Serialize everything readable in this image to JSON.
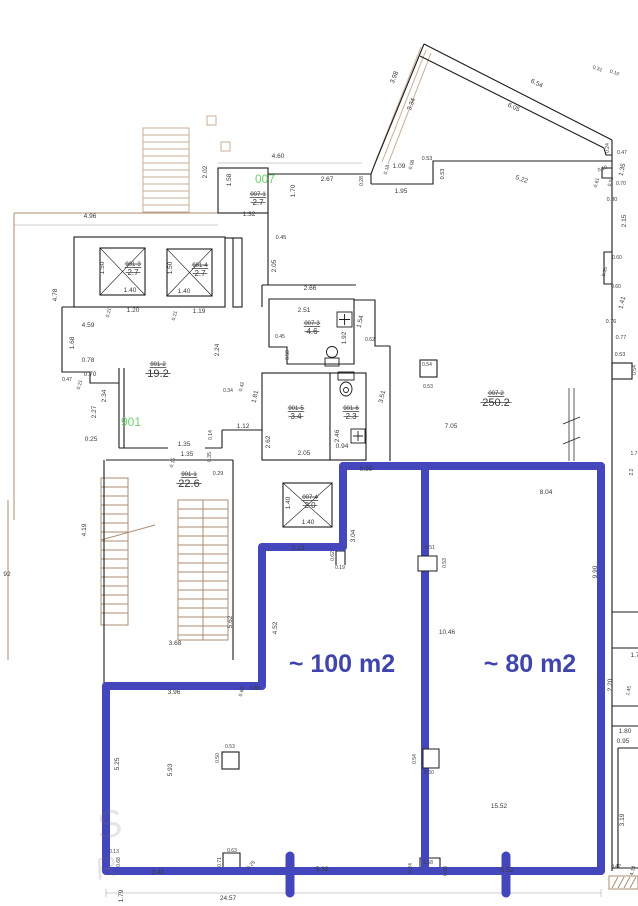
{
  "title": "floor-plan",
  "colors": {
    "wall_blue": "#4347bb",
    "label_blue": "#3f45ad",
    "green": "#6fd06f",
    "brown": "#ab8d73",
    "brown_light": "#c7ae97",
    "dim_text": "#3a3a3a",
    "wall_black": "#1c1c1c"
  },
  "area_labels": [
    {
      "t": "~ 100 m2",
      "x": 342,
      "y": 672
    },
    {
      "t": "~ 80 m2",
      "x": 530,
      "y": 672
    }
  ],
  "green_labels": [
    {
      "t": "007",
      "x": 265,
      "y": 183
    },
    {
      "t": "901",
      "x": 131,
      "y": 426
    }
  ],
  "room_labels": [
    {
      "code": "007-1",
      "value": "2.7",
      "x": 258,
      "y": 196,
      "big": false
    },
    {
      "code": "901-3",
      "value": "2.7",
      "x": 133,
      "y": 266,
      "big": false
    },
    {
      "code": "901-4",
      "value": "2.7",
      "x": 200,
      "y": 267,
      "big": false
    },
    {
      "code": "007-3",
      "value": "4.6",
      "x": 312,
      "y": 325,
      "big": false
    },
    {
      "code": "901-2",
      "value": "19.2",
      "x": 158,
      "y": 366,
      "big": true
    },
    {
      "code": "901-5",
      "value": "3.4",
      "x": 296,
      "y": 410,
      "big": false
    },
    {
      "code": "901-6",
      "value": "2.3",
      "x": 351,
      "y": 410,
      "big": false
    },
    {
      "code": "007-2",
      "value": "250.2",
      "x": 496,
      "y": 395,
      "big": true
    },
    {
      "code": "901-1",
      "value": "22.6",
      "x": 189,
      "y": 476,
      "big": true
    },
    {
      "code": "007-4",
      "value": "2.0",
      "x": 310,
      "y": 499,
      "big": false
    }
  ],
  "dims": [
    {
      "t": "4.96",
      "x": 90,
      "y": 218
    },
    {
      "t": "4.60",
      "x": 278,
      "y": 158
    },
    {
      "t": "2.02",
      "x": 207,
      "y": 172,
      "r": -90
    },
    {
      "t": "1.58",
      "x": 231,
      "y": 180,
      "r": -90
    },
    {
      "t": "2.67",
      "x": 327,
      "y": 181
    },
    {
      "t": "0.28",
      "x": 363,
      "y": 181,
      "r": -90,
      "s": 5
    },
    {
      "t": "1.09",
      "x": 399,
      "y": 168
    },
    {
      "t": "0.18",
      "x": 388,
      "y": 170,
      "r": -75,
      "s": 5
    },
    {
      "t": "0.08",
      "x": 413,
      "y": 165,
      "r": -75,
      "s": 5
    },
    {
      "t": "0.53",
      "x": 427,
      "y": 160,
      "s": 5.5
    },
    {
      "t": "1.95",
      "x": 401,
      "y": 193
    },
    {
      "t": "0.53",
      "x": 444,
      "y": 174,
      "r": -90,
      "s": 5.5
    },
    {
      "t": "1.70",
      "x": 295,
      "y": 191,
      "r": -90
    },
    {
      "t": "1.32",
      "x": 249,
      "y": 216
    },
    {
      "t": "0.45",
      "x": 281,
      "y": 239,
      "s": 5.5
    },
    {
      "t": "2.05",
      "x": 276,
      "y": 266,
      "r": -90
    },
    {
      "t": "3.98",
      "x": 396,
      "y": 78,
      "r": -68
    },
    {
      "t": "3.34",
      "x": 413,
      "y": 105,
      "r": -68
    },
    {
      "t": "6.54",
      "x": 536,
      "y": 85,
      "r": 26
    },
    {
      "t": "6.05",
      "x": 513,
      "y": 109,
      "r": 26
    },
    {
      "t": "5.22",
      "x": 521,
      "y": 181,
      "r": 20
    },
    {
      "t": "0.31",
      "x": 597,
      "y": 70,
      "r": 20,
      "s": 5
    },
    {
      "t": "0.10",
      "x": 614,
      "y": 74,
      "r": 20,
      "s": 5
    },
    {
      "t": "0.24",
      "x": 609,
      "y": 148,
      "r": -90,
      "s": 5
    },
    {
      "t": "0.47",
      "x": 622,
      "y": 154,
      "s": 5
    },
    {
      "t": "1.35",
      "x": 624,
      "y": 170,
      "r": -78
    },
    {
      "t": "0.10",
      "x": 603,
      "y": 170,
      "r": -20,
      "s": 5
    },
    {
      "t": "0.61",
      "x": 598,
      "y": 183,
      "r": -75,
      "s": 5
    },
    {
      "t": "0.51",
      "x": 612,
      "y": 182,
      "r": -75,
      "s": 5
    },
    {
      "t": "0.70",
      "x": 621,
      "y": 185,
      "s": 5
    },
    {
      "t": "0.80",
      "x": 612,
      "y": 201,
      "s": 5.5
    },
    {
      "t": "2.15",
      "x": 626,
      "y": 221,
      "r": -90
    },
    {
      "t": "0.60",
      "x": 617,
      "y": 259,
      "s": 5
    },
    {
      "t": "0.55",
      "x": 606,
      "y": 272,
      "r": -75,
      "s": 5
    },
    {
      "t": "0.60",
      "x": 616,
      "y": 288,
      "s": 5
    },
    {
      "t": "1.41",
      "x": 624,
      "y": 303,
      "r": -78
    },
    {
      "t": "0.76",
      "x": 611,
      "y": 323,
      "s": 5.5
    },
    {
      "t": "0.77",
      "x": 621,
      "y": 339,
      "s": 5.5
    },
    {
      "t": "0.53",
      "x": 620,
      "y": 356,
      "s": 5.5
    },
    {
      "t": "0.54",
      "x": 636,
      "y": 370,
      "r": -90,
      "s": 5
    },
    {
      "t": "1.50",
      "x": 104,
      "y": 268,
      "r": -90
    },
    {
      "t": "1.40",
      "x": 130,
      "y": 292
    },
    {
      "t": "1.50",
      "x": 172,
      "y": 268,
      "r": -90
    },
    {
      "t": "1.40",
      "x": 184,
      "y": 293
    },
    {
      "t": "0.21",
      "x": 110,
      "y": 313,
      "r": -75,
      "s": 5
    },
    {
      "t": "1.20",
      "x": 133,
      "y": 312
    },
    {
      "t": "0.21",
      "x": 176,
      "y": 316,
      "r": -75,
      "s": 5
    },
    {
      "t": "1.19",
      "x": 199,
      "y": 313
    },
    {
      "t": "4.59",
      "x": 88,
      "y": 327
    },
    {
      "t": "4.78",
      "x": 57,
      "y": 295,
      "r": -90
    },
    {
      "t": "1.68",
      "x": 74,
      "y": 343,
      "r": -90
    },
    {
      "t": "2.24",
      "x": 219,
      "y": 350,
      "r": -90
    },
    {
      "t": "2.66",
      "x": 310,
      "y": 290
    },
    {
      "t": "2.51",
      "x": 304,
      "y": 312
    },
    {
      "t": "0.45",
      "x": 280,
      "y": 338,
      "s": 5
    },
    {
      "t": "1.54",
      "x": 362,
      "y": 322,
      "r": -78
    },
    {
      "t": "1.92",
      "x": 346,
      "y": 338,
      "r": -90
    },
    {
      "t": "0.62",
      "x": 370,
      "y": 341,
      "s": 5
    },
    {
      "t": "0.58",
      "x": 289,
      "y": 355,
      "r": -90,
      "s": 5
    },
    {
      "t": "0.78",
      "x": 88,
      "y": 362
    },
    {
      "t": "0.70",
      "x": 90,
      "y": 376
    },
    {
      "t": "0.47",
      "x": 67,
      "y": 381,
      "s": 5
    },
    {
      "t": "0.21",
      "x": 81,
      "y": 385,
      "r": -75,
      "s": 5
    },
    {
      "t": "2.34",
      "x": 106,
      "y": 396,
      "r": -90
    },
    {
      "t": "2.27",
      "x": 96,
      "y": 412,
      "r": -90
    },
    {
      "t": "0.25",
      "x": 91,
      "y": 441
    },
    {
      "t": "0.34",
      "x": 228,
      "y": 392,
      "s": 5
    },
    {
      "t": "0.42",
      "x": 243,
      "y": 387,
      "r": -75,
      "s": 5
    },
    {
      "t": "1.81",
      "x": 257,
      "y": 397,
      "r": -78
    },
    {
      "t": "1.12",
      "x": 243,
      "y": 428
    },
    {
      "t": "0.14",
      "x": 212,
      "y": 435,
      "r": -90,
      "s": 5
    },
    {
      "t": "1.35",
      "x": 184,
      "y": 446
    },
    {
      "t": "1.35",
      "x": 187,
      "y": 456
    },
    {
      "t": "0.15",
      "x": 174,
      "y": 463,
      "r": -75,
      "s": 5
    },
    {
      "t": "0.35",
      "x": 211,
      "y": 457,
      "r": -90,
      "s": 5
    },
    {
      "t": "0.29",
      "x": 218,
      "y": 475,
      "s": 5.5
    },
    {
      "t": "2.62",
      "x": 270,
      "y": 442,
      "r": -90
    },
    {
      "t": "2.05",
      "x": 304,
      "y": 455
    },
    {
      "t": "2.46",
      "x": 339,
      "y": 436,
      "r": -90
    },
    {
      "t": "0.94",
      "x": 342,
      "y": 448
    },
    {
      "t": "3.51",
      "x": 384,
      "y": 397,
      "r": -78
    },
    {
      "t": "0.54",
      "x": 427,
      "y": 366,
      "s": 5
    },
    {
      "t": "0.53",
      "x": 428,
      "y": 388,
      "s": 5
    },
    {
      "t": "7.05",
      "x": 451,
      "y": 428
    },
    {
      "t": "0.99",
      "x": 366,
      "y": 471
    },
    {
      "t": "3.04",
      "x": 355,
      "y": 536,
      "r": -90
    },
    {
      "t": "1.40",
      "x": 290,
      "y": 503,
      "r": -90
    },
    {
      "t": "1.40",
      "x": 308,
      "y": 524
    },
    {
      "t": "2.23",
      "x": 298,
      "y": 550
    },
    {
      "t": "0.62",
      "x": 334,
      "y": 556,
      "r": -90,
      "s": 5
    },
    {
      "t": "0.19",
      "x": 340,
      "y": 569,
      "s": 5
    },
    {
      "t": "8.04",
      "x": 546,
      "y": 494
    },
    {
      "t": "0.51",
      "x": 430,
      "y": 549,
      "s": 5
    },
    {
      "t": "0.53",
      "x": 446,
      "y": 563,
      "r": -90,
      "s": 5
    },
    {
      "t": "9.90",
      "x": 597,
      "y": 572,
      "r": -90
    },
    {
      "t": "10.46",
      "x": 447,
      "y": 634
    },
    {
      "t": "4.52",
      "x": 277,
      "y": 628,
      "r": -90
    },
    {
      "t": "5.62",
      "x": 232,
      "y": 622,
      "r": -90
    },
    {
      "t": "3.68",
      "x": 175,
      "y": 645
    },
    {
      "t": "4.19",
      "x": 86,
      "y": 530,
      "r": -90
    },
    {
      "t": "92",
      "x": 7,
      "y": 576
    },
    {
      "t": "3.96",
      "x": 174,
      "y": 694
    },
    {
      "t": "0.60",
      "x": 243,
      "y": 692,
      "r": -75,
      "s": 5
    },
    {
      "t": "0.83",
      "x": 255,
      "y": 690,
      "s": 5
    },
    {
      "t": "5.25",
      "x": 119,
      "y": 764,
      "r": -90
    },
    {
      "t": "5.93",
      "x": 172,
      "y": 770,
      "r": -90
    },
    {
      "t": "0.50",
      "x": 219,
      "y": 758,
      "r": -90,
      "s": 5
    },
    {
      "t": "0.53",
      "x": 230,
      "y": 748,
      "s": 5
    },
    {
      "t": "15.52",
      "x": 499,
      "y": 808
    },
    {
      "t": "0.54",
      "x": 416,
      "y": 759,
      "r": -90,
      "s": 5
    },
    {
      "t": "0.60",
      "x": 429,
      "y": 774,
      "s": 5
    },
    {
      "t": "0.13",
      "x": 114,
      "y": 853,
      "s": 5
    },
    {
      "t": "0.68",
      "x": 120,
      "y": 862,
      "r": -90,
      "s": 5
    },
    {
      "t": "3.40",
      "x": 158,
      "y": 874
    },
    {
      "t": "0.63",
      "x": 232,
      "y": 852,
      "s": 5
    },
    {
      "t": "0.71",
      "x": 221,
      "y": 862,
      "r": -90,
      "s": 5
    },
    {
      "t": "0.25",
      "x": 252,
      "y": 866,
      "r": -45,
      "s": 5
    },
    {
      "t": "24.57",
      "x": 228,
      "y": 900
    },
    {
      "t": "1.79",
      "x": 123,
      "y": 896,
      "r": -90
    },
    {
      "t": "5.38",
      "x": 322,
      "y": 871
    },
    {
      "t": "5.52",
      "x": 507,
      "y": 872
    },
    {
      "t": "0.24",
      "x": 412,
      "y": 868,
      "r": -90,
      "s": 5
    },
    {
      "t": "1.58",
      "x": 428,
      "y": 864,
      "s": 5
    },
    {
      "t": "0.38",
      "x": 447,
      "y": 871,
      "r": -90,
      "s": 5
    },
    {
      "t": "1.80",
      "x": 625,
      "y": 733
    },
    {
      "t": "0.95",
      "x": 623,
      "y": 743
    },
    {
      "t": "2.20",
      "x": 612,
      "y": 685,
      "r": -90
    },
    {
      "t": "1.45",
      "x": 630,
      "y": 691,
      "r": -78,
      "s": 5
    },
    {
      "t": "1.7",
      "x": 635,
      "y": 657
    },
    {
      "t": "3.19",
      "x": 624,
      "y": 820,
      "r": -90
    },
    {
      "t": "0.42",
      "x": 616,
      "y": 868,
      "s": 5
    },
    {
      "t": "4.14",
      "x": 634,
      "y": 871,
      "r": -75,
      "s": 5
    },
    {
      "t": "1.7",
      "x": 634,
      "y": 455,
      "s": 5
    },
    {
      "t": "2.2",
      "x": 633,
      "y": 472,
      "r": -90,
      "s": 5
    }
  ],
  "watermark": [
    {
      "t": "S",
      "x": 100,
      "y": 840
    },
    {
      "t": "R",
      "x": 98,
      "y": 880
    }
  ]
}
